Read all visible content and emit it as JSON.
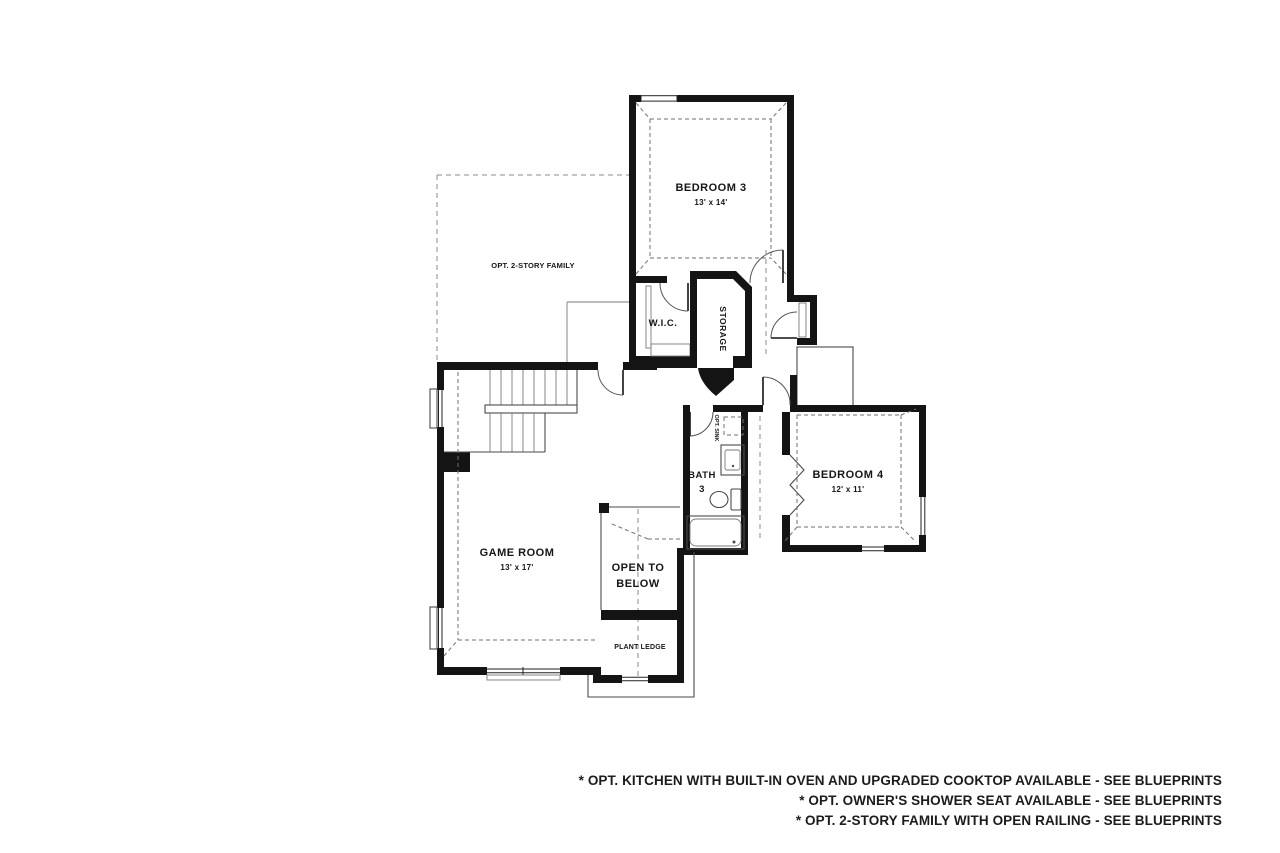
{
  "plan": {
    "rooms": {
      "bedroom3": {
        "label": "BEDROOM 3",
        "dims": "13' x 14'"
      },
      "bedroom4": {
        "label": "BEDROOM 4",
        "dims": "12' x 11'"
      },
      "game_room": {
        "label": "GAME ROOM",
        "dims": "13' x 17'"
      },
      "wic": {
        "label": "W.I.C."
      },
      "storage": {
        "label": "STORAGE"
      },
      "bath3": {
        "label_line1": "BATH",
        "label_line2": "3"
      },
      "opt_family": {
        "label": "OPT. 2-STORY FAMILY"
      },
      "open_to_below": {
        "label_line1": "OPEN TO",
        "label_line2": "BELOW"
      },
      "plant_ledge": {
        "label": "PLANT LEDGE"
      },
      "opt_sink": {
        "label": "OPT. SINK"
      }
    }
  },
  "footer": {
    "notes": [
      "* OPT. KITCHEN WITH BUILT-IN OVEN AND UPGRADED COOKTOP AVAILABLE  - SEE BLUEPRINTS",
      "* OPT. OWNER'S SHOWER SEAT AVAILABLE - SEE BLUEPRINTS",
      "* OPT. 2-STORY FAMILY WITH OPEN RAILING - SEE BLUEPRINTS"
    ]
  },
  "colors": {
    "wall": "#141414",
    "thin_line": "#4a4a4a",
    "dashed_line": "#8b8b8b",
    "text": "#161616",
    "background": "#ffffff"
  }
}
